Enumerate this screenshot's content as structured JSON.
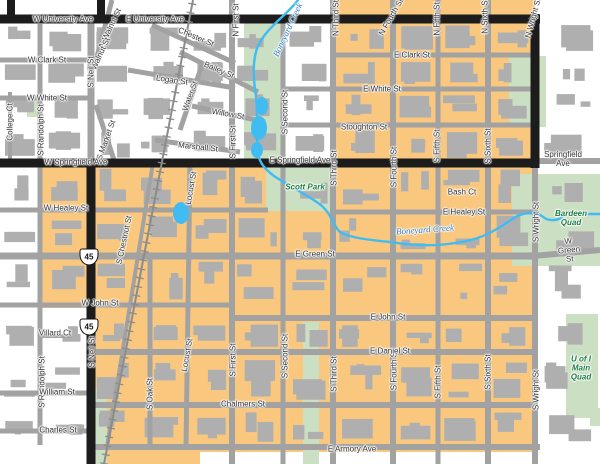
{
  "map": {
    "title": "Campus-town street map",
    "colors": {
      "background": "#ffffff",
      "district_orange": "#F9C87E",
      "park_green": "#CBDFC2",
      "road_gray": "#A2A2A2",
      "building_gray": "#AFAFAF",
      "major_road_black": "#1C1C1C",
      "railroad_gray": "#8C8C8C",
      "water_blue": "#41BCF2",
      "road_label": "#333333",
      "park_label": "#1B7F43",
      "water_label": "#2E7CC9"
    },
    "highway_shields": [
      {
        "route": "45",
        "x": 89,
        "y": 257
      },
      {
        "route": "45",
        "x": 89,
        "y": 327
      }
    ],
    "labels": [
      {
        "t": "W University Ave",
        "x": 63,
        "y": 19,
        "r": 0,
        "k": "road"
      },
      {
        "t": "E University Ave",
        "x": 155,
        "y": 19,
        "r": 0,
        "k": "road"
      },
      {
        "t": "W Clark St",
        "x": 47,
        "y": 60,
        "r": 0,
        "k": "road"
      },
      {
        "t": "Chester St",
        "x": 196,
        "y": 37,
        "r": 23,
        "k": "road"
      },
      {
        "t": "Bailey St",
        "x": 219,
        "y": 70,
        "r": 23,
        "k": "road"
      },
      {
        "t": "Logan St",
        "x": 172,
        "y": 80,
        "r": 8,
        "k": "road"
      },
      {
        "t": "Water St",
        "x": 190,
        "y": 96,
        "r": -70,
        "k": "road"
      },
      {
        "t": "N Walnut St",
        "x": 110,
        "y": 28,
        "r": -65,
        "k": "road"
      },
      {
        "t": "S Walnut St",
        "x": 99,
        "y": 57,
        "r": -65,
        "k": "road"
      },
      {
        "t": "S Market St",
        "x": 106,
        "y": 140,
        "r": -70,
        "k": "road"
      },
      {
        "t": "S Neil St",
        "x": 91,
        "y": 72,
        "r": -90,
        "k": "road"
      },
      {
        "t": "W White St",
        "x": 47,
        "y": 98,
        "r": 0,
        "k": "road"
      },
      {
        "t": "College Ct",
        "x": 10,
        "y": 122,
        "r": -90,
        "k": "road"
      },
      {
        "t": "S Randolph St",
        "x": 41,
        "y": 130,
        "r": -90,
        "k": "road"
      },
      {
        "t": "Willow St",
        "x": 228,
        "y": 114,
        "r": 10,
        "k": "road"
      },
      {
        "t": "Marshall St",
        "x": 198,
        "y": 147,
        "r": 6,
        "k": "road"
      },
      {
        "t": "N First St",
        "x": 236,
        "y": 20,
        "r": -90,
        "k": "road"
      },
      {
        "t": "S First St",
        "x": 233,
        "y": 142,
        "r": -90,
        "k": "road"
      },
      {
        "t": "S First St",
        "x": 233,
        "y": 360,
        "r": -90,
        "k": "road"
      },
      {
        "t": "S Second St",
        "x": 285,
        "y": 112,
        "r": -90,
        "k": "road"
      },
      {
        "t": "S Second St",
        "x": 285,
        "y": 356,
        "r": -90,
        "k": "road"
      },
      {
        "t": "N Third St",
        "x": 336,
        "y": 18,
        "r": -90,
        "k": "road"
      },
      {
        "t": "S Third St",
        "x": 334,
        "y": 168,
        "r": -90,
        "k": "road"
      },
      {
        "t": "S Third St",
        "x": 334,
        "y": 374,
        "r": -90,
        "k": "road"
      },
      {
        "t": "N Fourth St",
        "x": 391,
        "y": 17,
        "r": -60,
        "k": "road"
      },
      {
        "t": "S Fourth St",
        "x": 394,
        "y": 167,
        "r": -90,
        "k": "road"
      },
      {
        "t": "S Fourth St",
        "x": 394,
        "y": 370,
        "r": -90,
        "k": "road"
      },
      {
        "t": "N Fifth St",
        "x": 437,
        "y": 19,
        "r": -90,
        "k": "road"
      },
      {
        "t": "S Fifth St",
        "x": 437,
        "y": 146,
        "r": -90,
        "k": "road"
      },
      {
        "t": "S Fifth St",
        "x": 438,
        "y": 382,
        "r": -90,
        "k": "road"
      },
      {
        "t": "N Sixth St",
        "x": 485,
        "y": 16,
        "r": -90,
        "k": "road"
      },
      {
        "t": "S Sixth St",
        "x": 488,
        "y": 146,
        "r": -90,
        "k": "road"
      },
      {
        "t": "S Sixth St",
        "x": 488,
        "y": 372,
        "r": -90,
        "k": "road"
      },
      {
        "t": "N Wright St",
        "x": 533,
        "y": 18,
        "r": -75,
        "k": "road"
      },
      {
        "t": "S Wright St",
        "x": 536,
        "y": 222,
        "r": -90,
        "k": "road"
      },
      {
        "t": "S Wright St",
        "x": 536,
        "y": 390,
        "r": -90,
        "k": "road"
      },
      {
        "t": "E Clark St",
        "x": 412,
        "y": 55,
        "r": 0,
        "k": "road"
      },
      {
        "t": "E White St",
        "x": 382,
        "y": 89,
        "r": 0,
        "k": "road"
      },
      {
        "t": "Stoughton St",
        "x": 364,
        "y": 127,
        "r": 0,
        "k": "road"
      },
      {
        "t": "W Springfield Ave",
        "x": 76,
        "y": 162,
        "r": 0,
        "k": "road"
      },
      {
        "t": "E Springfield Ave",
        "x": 300,
        "y": 160,
        "r": 0,
        "k": "road"
      },
      {
        "t": "Springfield Ave",
        "x": 563,
        "y": 159,
        "r": 0,
        "k": "road"
      },
      {
        "t": "W Healey St",
        "x": 66,
        "y": 208,
        "r": 0,
        "k": "road"
      },
      {
        "t": "E Healey St",
        "x": 464,
        "y": 212,
        "r": 0,
        "k": "road"
      },
      {
        "t": "Bash Ct",
        "x": 462,
        "y": 192,
        "r": 0,
        "k": "road"
      },
      {
        "t": "E Green St",
        "x": 315,
        "y": 254,
        "r": 0,
        "k": "road"
      },
      {
        "t": "W Green St",
        "x": 569,
        "y": 250,
        "r": -5,
        "k": "road"
      },
      {
        "t": "W John St",
        "x": 100,
        "y": 303,
        "r": 0,
        "k": "road"
      },
      {
        "t": "E John St",
        "x": 388,
        "y": 317,
        "r": 0,
        "k": "road"
      },
      {
        "t": "E Daniel St",
        "x": 390,
        "y": 351,
        "r": 0,
        "k": "road"
      },
      {
        "t": "Chalmers St",
        "x": 243,
        "y": 404,
        "r": 0,
        "k": "road"
      },
      {
        "t": "E Armory Ave",
        "x": 352,
        "y": 449,
        "r": 0,
        "k": "road"
      },
      {
        "t": "Villard Ct",
        "x": 55,
        "y": 333,
        "r": 0,
        "k": "road"
      },
      {
        "t": "S Randolph St",
        "x": 42,
        "y": 382,
        "r": -90,
        "k": "road"
      },
      {
        "t": "William St",
        "x": 57,
        "y": 392,
        "r": 0,
        "k": "road"
      },
      {
        "t": "Charles St",
        "x": 58,
        "y": 430,
        "r": 0,
        "k": "road"
      },
      {
        "t": "S Oak St",
        "x": 150,
        "y": 394,
        "r": -90,
        "k": "road"
      },
      {
        "t": "Locust St",
        "x": 191,
        "y": 188,
        "r": -80,
        "k": "road"
      },
      {
        "t": "Locust St",
        "x": 187,
        "y": 355,
        "r": -80,
        "k": "road"
      },
      {
        "t": "S Chestnut St",
        "x": 124,
        "y": 240,
        "r": -78,
        "k": "road"
      },
      {
        "t": "S Neil St",
        "x": 92,
        "y": 352,
        "r": -90,
        "k": "road"
      },
      {
        "t": "Scott Park",
        "x": 305,
        "y": 187,
        "r": 0,
        "k": "park"
      },
      {
        "t": "Bardeen Quad",
        "x": 571,
        "y": 218,
        "r": 0,
        "k": "park"
      },
      {
        "t": "U of I\nMain\nQuad",
        "x": 581,
        "y": 368,
        "r": 0,
        "k": "park"
      },
      {
        "t": "Boneyard Creek",
        "x": 288,
        "y": 30,
        "r": -65,
        "k": "water"
      },
      {
        "t": "Boneyard Creek",
        "x": 425,
        "y": 230,
        "r": -4,
        "k": "water"
      }
    ]
  }
}
